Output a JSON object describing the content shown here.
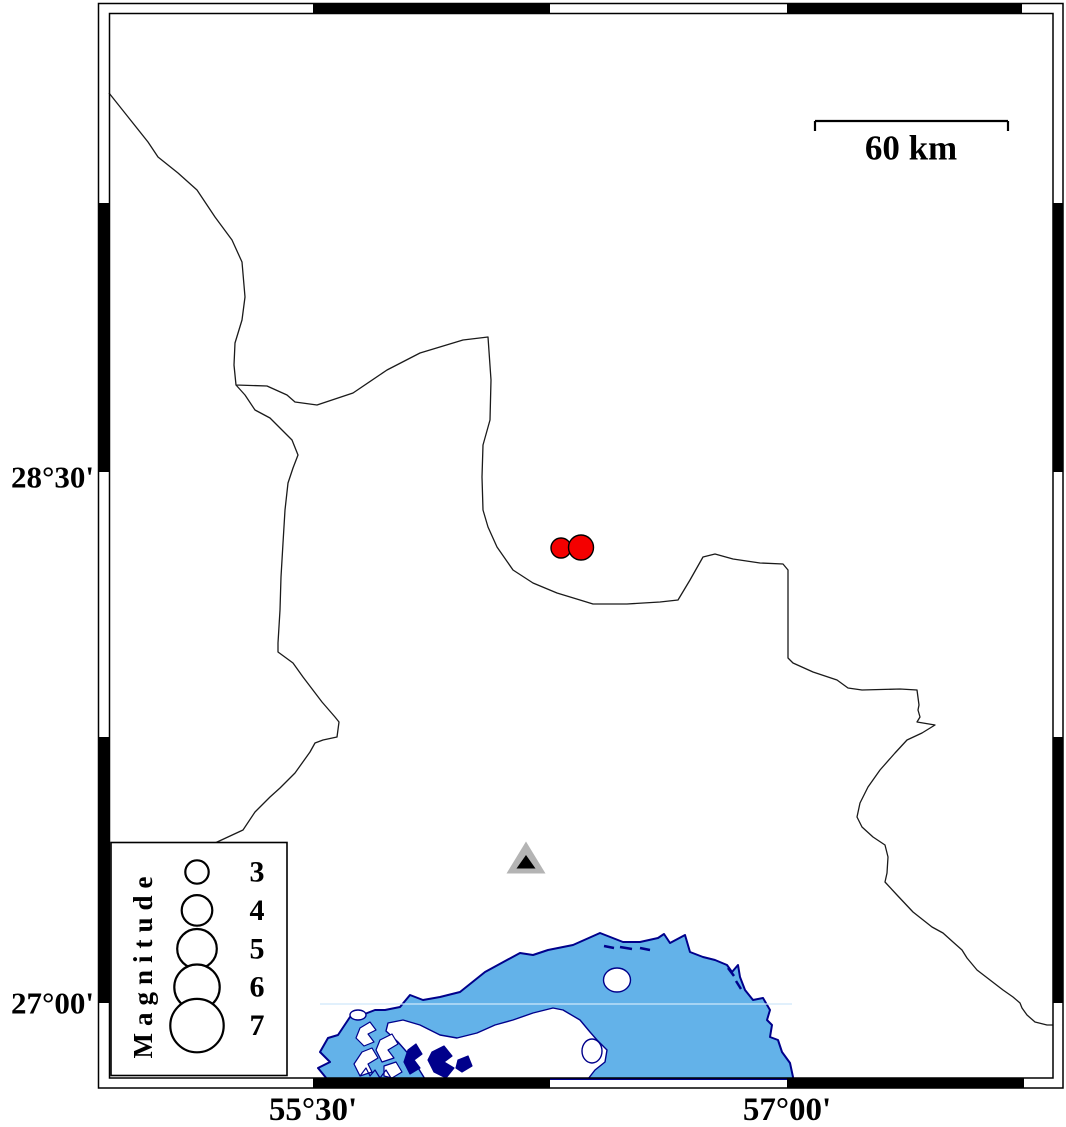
{
  "frame": {
    "left_labels": [
      {
        "text": "28°30'"
      },
      {
        "text": "27°00'"
      }
    ],
    "bottom_labels": [
      {
        "text": "55°30'"
      },
      {
        "text": "57°00'"
      }
    ]
  },
  "scalebar": {
    "label": "60 km"
  },
  "legend": {
    "title": "Magnitude",
    "entries": [
      {
        "label": "3",
        "radius": 11.7
      },
      {
        "label": "4",
        "radius": 15.3
      },
      {
        "label": "5",
        "radius": 19.8
      },
      {
        "label": "6",
        "radius": 22.7
      },
      {
        "label": "7",
        "radius": 26.7
      }
    ]
  },
  "markers": {
    "earthquakes": [
      {
        "x": 561,
        "y": 548,
        "radius": 10
      },
      {
        "x": 581,
        "y": 547.5,
        "radius": 12.5
      }
    ],
    "station": {
      "x": 526,
      "apex_y": 841.5,
      "base_y": 873.5,
      "half_width": 19.5,
      "core_apex_y": 855,
      "core_base_y": 868.5,
      "core_half_width": 9.5
    }
  },
  "colors": {
    "water": "#63b2e9",
    "coastline": "#00008b",
    "earthquake_fill": "#f40000",
    "station_fill": "#b4b4b4",
    "station_core": "#000000"
  }
}
